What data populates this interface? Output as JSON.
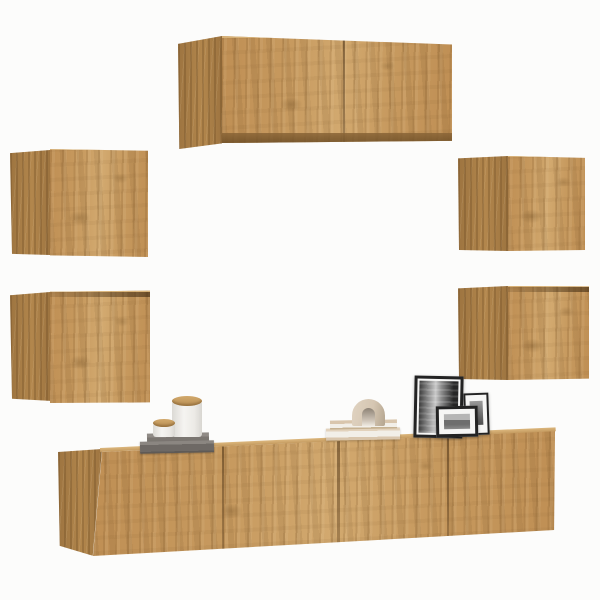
{
  "scene": {
    "type": "product-photo",
    "description": "7-piece wall-mounted TV furniture set in artisan oak, floating on a white wall, styled with candles, books, an arch ornament and photo frames"
  },
  "palette": {
    "background": "#fcfcfb",
    "wood_light": "#d2a96f",
    "wood_mid": "#c79a5f",
    "wood_dark": "#bf8f54",
    "wood_side_light": "#b2864c",
    "wood_side_dark": "#9d7440",
    "wood_edge_highlight": "#dcb77d",
    "wood_bottom_shade": "#8a6537",
    "frame_black": "#232323",
    "mat_white": "#f6f6f5",
    "photo_dark": "#3d3d3d",
    "photo_light": "#c9c9c9",
    "candle_white": "#f5f4f1",
    "candle_shade": "#dcdad5",
    "lid_tan": "#c79f63",
    "tray_gray_top": "#908b86",
    "tray_gray_front": "#6e6965",
    "book_beige": "#d9c6ad",
    "book_pages": "#f2efe8",
    "arch_beige": "#d5c6b2",
    "arch_inner": "#8d8275"
  },
  "furniture": [
    {
      "id": "wall-cabinet-top",
      "label": "Top floating wall cabinet with two doors"
    },
    {
      "id": "wall-cabinet-left-upper",
      "label": "Upper left square wall cabinet"
    },
    {
      "id": "wall-cabinet-left-lower",
      "label": "Lower left square wall cabinet"
    },
    {
      "id": "wall-cabinet-right-upper",
      "label": "Upper right square wall cabinet"
    },
    {
      "id": "wall-cabinet-right-lower",
      "label": "Lower right square wall cabinet"
    },
    {
      "id": "tv-stand-left",
      "label": "Left floating TV stand unit with two doors"
    },
    {
      "id": "tv-stand-right",
      "label": "Right floating TV stand unit with two doors"
    }
  ],
  "decor": [
    {
      "id": "gray-book-stack",
      "label": "Stack of two gray books under candles"
    },
    {
      "id": "candle-large",
      "label": "Large white candle jar with wooden lid"
    },
    {
      "id": "candle-small",
      "label": "Small white candle jar with wooden lid"
    },
    {
      "id": "beige-book-stack",
      "label": "Stack of two beige books"
    },
    {
      "id": "arch-ornament",
      "label": "Beige arch-shaped ornament"
    },
    {
      "id": "photo-frame-large",
      "label": "Large black frame with black-and-white city photo"
    },
    {
      "id": "photo-frame-right",
      "label": "Tall small black photo frame"
    },
    {
      "id": "photo-frame-front",
      "label": "Small landscape black photo frame"
    }
  ]
}
